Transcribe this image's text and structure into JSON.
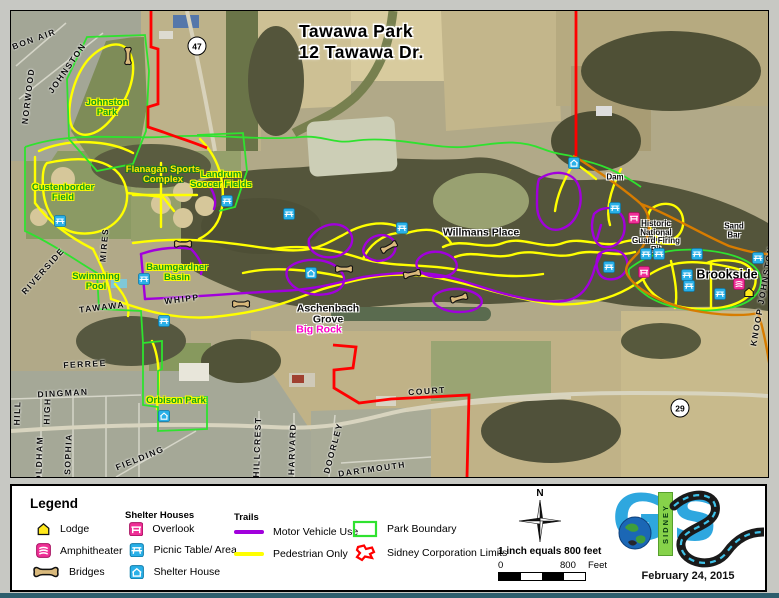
{
  "title": {
    "line1": "Tawawa Park",
    "line2": "12 Tawawa Dr."
  },
  "colors": {
    "pedestrian_trail": "#ffff00",
    "motor_trail": "#a100dc",
    "park_boundary": "#2fe22f",
    "sidney_limits": "#ff0000",
    "park_road": "#d77c00",
    "icon_blue": "#29b0e8",
    "icon_pink": "#ef2f96",
    "lodge_yellow": "#ffe81c",
    "bridge_tan": "#d9b97c",
    "logo_blue": "#2ea7df",
    "logo_green": "#86d24a"
  },
  "map": {
    "park_labels": [
      {
        "name": "johnston-park",
        "lines": [
          "Johnston",
          "Park"
        ],
        "x": 96,
        "y": 97,
        "style": "green"
      },
      {
        "name": "custenborder-field",
        "lines": [
          "Custenborder",
          "Field"
        ],
        "x": 52,
        "y": 182,
        "style": "green"
      },
      {
        "name": "flanagan-sports-complex",
        "lines": [
          "Flanagan Sports",
          "Complex"
        ],
        "x": 152,
        "y": 164,
        "style": "yellow"
      },
      {
        "name": "landrum-soccer-fields",
        "lines": [
          "Landrum",
          "Soccer Fields"
        ],
        "x": 210,
        "y": 169,
        "style": "green"
      },
      {
        "name": "swimming-pool",
        "lines": [
          "Swimming",
          "Pool"
        ],
        "x": 85,
        "y": 271,
        "style": "green"
      },
      {
        "name": "baumgardner-basin",
        "lines": [
          "Baumgardner",
          "Basin"
        ],
        "x": 166,
        "y": 262,
        "style": "green"
      },
      {
        "name": "orbison-park",
        "lines": [
          "Orbison Park"
        ],
        "x": 165,
        "y": 390,
        "style": "green"
      },
      {
        "name": "aschenbach-grove",
        "lines": [
          "Aschenbach",
          "Grove"
        ],
        "x": 317,
        "y": 304,
        "style": "black"
      },
      {
        "name": "big-rock",
        "lines": [
          "Big Rock"
        ],
        "x": 308,
        "y": 319,
        "style": "magenta"
      },
      {
        "name": "willmans-place",
        "lines": [
          "Willmans Place"
        ],
        "x": 470,
        "y": 222,
        "style": "black"
      },
      {
        "name": "dam",
        "lines": [
          "Dam"
        ],
        "x": 604,
        "y": 167,
        "style": "black-sm"
      },
      {
        "name": "historic-national-guard-firing-pit",
        "lines": [
          "Historic",
          "National",
          "Guard Firing",
          "Pit"
        ],
        "x": 645,
        "y": 226,
        "style": "black-sm"
      },
      {
        "name": "sand-bar",
        "lines": [
          "Sand",
          "Bar"
        ],
        "x": 723,
        "y": 220,
        "style": "black-sm"
      },
      {
        "name": "brookside",
        "lines": [
          "Brookside"
        ],
        "x": 716,
        "y": 264,
        "style": "black-lg"
      }
    ],
    "street_labels": [
      {
        "name": "bon-air",
        "text": "BON AIR",
        "x": 23,
        "y": 28,
        "rot": -20
      },
      {
        "name": "johnston-st",
        "text": "JOHNSTON",
        "x": 56,
        "y": 57,
        "rot": -55
      },
      {
        "name": "norwood",
        "text": "NORWOOD",
        "x": 17,
        "y": 85,
        "rot": -83
      },
      {
        "name": "mires",
        "text": "MIRES",
        "x": 93,
        "y": 234,
        "rot": -85
      },
      {
        "name": "riverside",
        "text": "RIVERSIDE",
        "x": 32,
        "y": 260,
        "rot": -48
      },
      {
        "name": "tawawa-st",
        "text": "TAWAWA",
        "x": 91,
        "y": 296,
        "rot": -7
      },
      {
        "name": "whipp",
        "text": "WHIPP",
        "x": 171,
        "y": 288,
        "rot": -7
      },
      {
        "name": "ferree",
        "text": "FERREE",
        "x": 74,
        "y": 353,
        "rot": -3
      },
      {
        "name": "dingman",
        "text": "DINGMAN",
        "x": 52,
        "y": 382,
        "rot": -3
      },
      {
        "name": "hill",
        "text": "HILL",
        "x": 6,
        "y": 402,
        "rot": -88
      },
      {
        "name": "high",
        "text": "HIGH",
        "x": 36,
        "y": 400,
        "rot": -88
      },
      {
        "name": "oldham",
        "text": "OLDHAM",
        "x": 28,
        "y": 448,
        "rot": -88
      },
      {
        "name": "sophia",
        "text": "SOPHIA",
        "x": 57,
        "y": 443,
        "rot": -88
      },
      {
        "name": "fielding",
        "text": "FIELDING",
        "x": 129,
        "y": 447,
        "rot": -22
      },
      {
        "name": "hillcrest",
        "text": "HILLCREST",
        "x": 246,
        "y": 436,
        "rot": -88
      },
      {
        "name": "harvard",
        "text": "HARVARD",
        "x": 281,
        "y": 438,
        "rot": -88
      },
      {
        "name": "doorley",
        "text": "DOORLEY",
        "x": 322,
        "y": 437,
        "rot": -75
      },
      {
        "name": "dartmouth",
        "text": "DARTMOUTH",
        "x": 361,
        "y": 458,
        "rot": -8
      },
      {
        "name": "court",
        "text": "COURT",
        "x": 416,
        "y": 380,
        "rot": -4
      },
      {
        "name": "knoop-johnston",
        "text": "KNOOP JOHNSTON",
        "x": 751,
        "y": 285,
        "rot": -80
      }
    ],
    "route_shields": [
      {
        "number": "47",
        "x": 186,
        "y": 35
      },
      {
        "number": "29",
        "x": 669,
        "y": 397
      }
    ],
    "icons": [
      {
        "type": "bridge",
        "x": 117,
        "y": 45,
        "rot": 90
      },
      {
        "type": "bridge",
        "x": 172,
        "y": 233,
        "rot": 0
      },
      {
        "type": "bridge",
        "x": 378,
        "y": 236,
        "rot": -28
      },
      {
        "type": "bridge",
        "x": 333,
        "y": 258,
        "rot": 0
      },
      {
        "type": "bridge",
        "x": 401,
        "y": 263,
        "rot": -12
      },
      {
        "type": "bridge",
        "x": 448,
        "y": 287,
        "rot": -15
      },
      {
        "type": "bridge",
        "x": 230,
        "y": 293,
        "rot": 0
      },
      {
        "type": "picnic",
        "x": 49,
        "y": 210
      },
      {
        "type": "picnic",
        "x": 216,
        "y": 190
      },
      {
        "type": "picnic",
        "x": 133,
        "y": 268
      },
      {
        "type": "picnic",
        "x": 153,
        "y": 310
      },
      {
        "type": "picnic",
        "x": 278,
        "y": 203
      },
      {
        "type": "picnic",
        "x": 391,
        "y": 217
      },
      {
        "type": "picnic",
        "x": 604,
        "y": 197
      },
      {
        "type": "picnic",
        "x": 635,
        "y": 243
      },
      {
        "type": "picnic",
        "x": 648,
        "y": 243
      },
      {
        "type": "picnic",
        "x": 686,
        "y": 243
      },
      {
        "type": "picnic",
        "x": 747,
        "y": 247
      },
      {
        "type": "picnic",
        "x": 598,
        "y": 256
      },
      {
        "type": "picnic",
        "x": 676,
        "y": 264
      },
      {
        "type": "picnic",
        "x": 678,
        "y": 275
      },
      {
        "type": "picnic",
        "x": 709,
        "y": 283
      },
      {
        "type": "shelter",
        "x": 300,
        "y": 262
      },
      {
        "type": "shelter",
        "x": 563,
        "y": 152
      },
      {
        "type": "shelter",
        "x": 153,
        "y": 405
      },
      {
        "type": "overlook",
        "x": 623,
        "y": 207
      },
      {
        "type": "overlook",
        "x": 633,
        "y": 261
      },
      {
        "type": "amphitheater",
        "x": 728,
        "y": 273
      },
      {
        "type": "lodge",
        "x": 738,
        "y": 281
      }
    ]
  },
  "legend": {
    "title": "Legend",
    "features": [
      {
        "label": "Lodge",
        "icon": "lodge"
      },
      {
        "label": "Amphitheater",
        "icon": "amphitheater"
      },
      {
        "label": "Bridges",
        "icon": "bridge"
      }
    ],
    "shelter_houses": {
      "title": "Shelter Houses",
      "items": [
        {
          "label": "Overlook",
          "icon": "overlook"
        },
        {
          "label": "Picnic Table/ Area",
          "icon": "picnic"
        },
        {
          "label": "Shelter House",
          "icon": "shelter"
        }
      ]
    },
    "trails": {
      "title": "Trails",
      "items": [
        {
          "label": "Motor Vehicle Use",
          "color_key": "motor_trail"
        },
        {
          "label": "Pedestrian Only",
          "color_key": "pedestrian_trail"
        }
      ]
    },
    "boundaries": [
      {
        "label": "Park Boundary",
        "icon": "park-boundary"
      },
      {
        "label": "Sidney Corporation Limits",
        "icon": "sidney-limits"
      }
    ],
    "compass_label": "N",
    "scale_text": "1 inch equals 800 feet",
    "scale_start": "0",
    "scale_end": "800",
    "scale_unit": "Feet",
    "logo": {
      "g": "G",
      "s": "S",
      "sidney": "SIDNEY",
      "date": "February 24, 2015"
    }
  }
}
